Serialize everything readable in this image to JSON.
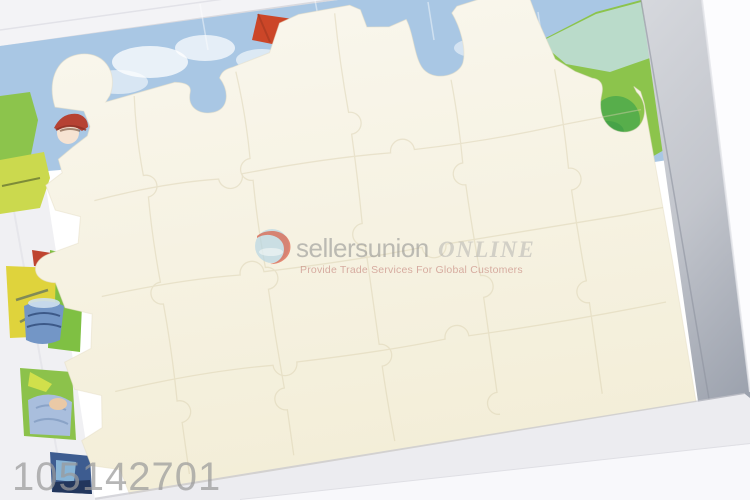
{
  "watermark": {
    "logo_icon": "globe-swirl-icon",
    "brand": "sellersunion",
    "brand_suffix": "ONLINE",
    "tagline": "Provide Trade Services For Global Customers"
  },
  "overlay": {
    "product_id": "105142701"
  },
  "colors": {
    "background": "#ffffff",
    "box_rim": "#f3f3f6",
    "box_wall_light": "#d6d8dd",
    "box_wall_mid": "#c2c5cc",
    "box_wall_dark": "#9aa0ac",
    "outer_white": "#fcfcfe",
    "band_inner": "#ececf0",
    "band_outer": "#f8f8fb",
    "left_sliver": "#f0f0f3",
    "sky_blue": "#a9c7e4",
    "cloud_white": "#ffffff",
    "grass_green": "#8cc44c",
    "leaf_green_dark": "#57ae4b",
    "teal_wash": "#c2dfe0",
    "kite_red": "#cc4628",
    "marker_orange": "#dd9c33",
    "cream_piece_light": "#f9f6ec",
    "cream_piece_dark": "#f3eed8",
    "piece_outline": "#d9cfae",
    "yellow_patch": "#dfd33c",
    "yellow_green_patch": "#cbd94e",
    "red_patch": "#bf4430",
    "cloth_blue": "#7396c6",
    "cloth_blue_light": "#a9bedd",
    "navy": "#2e4a78",
    "skin": "#eac9a6",
    "cap_red": "#b64233",
    "face_skin": "#f6e3d2",
    "slate_blue": "#3d5c90",
    "slate_light": "#87b4d6",
    "slate_dark": "#22365c",
    "watermark_circle": "#b5d6e4",
    "watermark_swoosh": "#d84b32",
    "watermark_text": "#8e8e8e",
    "watermark_suffix": "#a5a5a5",
    "watermark_tagline": "#c5837b",
    "product_id_gray": "#9b9b9b"
  }
}
